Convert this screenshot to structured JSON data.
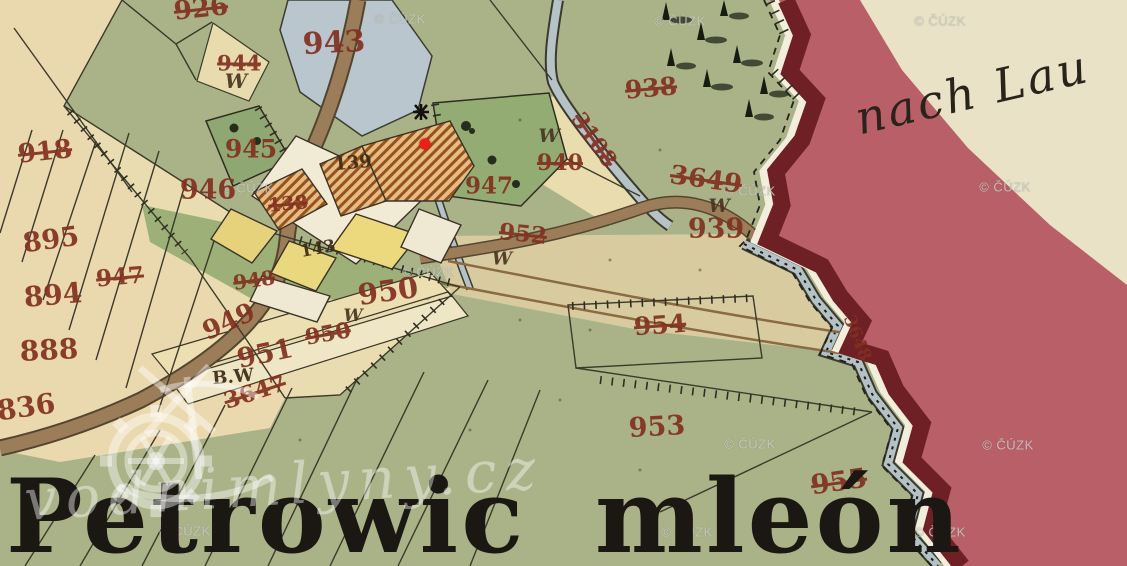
{
  "map": {
    "region_label": "Petrowic mleón",
    "direction_label": "nach Lau",
    "parcel_labels": [
      {
        "text": "926",
        "x": 201,
        "y": 9,
        "size": 26,
        "rot": -6,
        "struck": true,
        "cls": "red"
      },
      {
        "text": "943",
        "x": 334,
        "y": 43,
        "size": 30,
        "rot": -3,
        "struck": false,
        "cls": "red"
      },
      {
        "text": "944",
        "x": 239,
        "y": 63,
        "size": 21,
        "rot": 0,
        "struck": true,
        "cls": "red"
      },
      {
        "text": "W",
        "x": 236,
        "y": 81,
        "size": 20,
        "rot": 0,
        "struck": false,
        "cls": "w"
      },
      {
        "text": "918",
        "x": 45,
        "y": 152,
        "size": 26,
        "rot": -6,
        "struck": true,
        "cls": "red"
      },
      {
        "text": "945",
        "x": 251,
        "y": 149,
        "size": 25,
        "rot": 0,
        "struck": false,
        "cls": "red"
      },
      {
        "text": "946",
        "x": 208,
        "y": 190,
        "size": 27,
        "rot": 0,
        "struck": false,
        "cls": "red"
      },
      {
        "text": "938",
        "x": 651,
        "y": 88,
        "size": 25,
        "rot": -5,
        "struck": true,
        "cls": "red"
      },
      {
        "text": "W",
        "x": 549,
        "y": 136,
        "size": 19,
        "rot": 0,
        "struck": false,
        "cls": "w"
      },
      {
        "text": "940",
        "x": 560,
        "y": 163,
        "size": 22,
        "rot": 0,
        "struck": true,
        "cls": "red"
      },
      {
        "text": "947",
        "x": 489,
        "y": 186,
        "size": 23,
        "rot": 0,
        "struck": false,
        "cls": "red"
      },
      {
        "text": "947",
        "x": 120,
        "y": 277,
        "size": 23,
        "rot": -5,
        "struck": true,
        "cls": "red"
      },
      {
        "text": "895",
        "x": 51,
        "y": 240,
        "size": 27,
        "rot": -8,
        "struck": false,
        "cls": "red"
      },
      {
        "text": "894",
        "x": 53,
        "y": 295,
        "size": 28,
        "rot": -5,
        "struck": false,
        "cls": "red"
      },
      {
        "text": "888",
        "x": 49,
        "y": 350,
        "size": 28,
        "rot": -3,
        "struck": false,
        "cls": "red"
      },
      {
        "text": "836",
        "x": 26,
        "y": 407,
        "size": 28,
        "rot": -8,
        "struck": false,
        "cls": "red"
      },
      {
        "text": "3649",
        "x": 706,
        "y": 180,
        "size": 26,
        "rot": 8,
        "struck": true,
        "cls": "red"
      },
      {
        "text": "W",
        "x": 719,
        "y": 206,
        "size": 19,
        "rot": 0,
        "struck": false,
        "cls": "w"
      },
      {
        "text": "939",
        "x": 716,
        "y": 229,
        "size": 27,
        "rot": 0,
        "struck": false,
        "cls": "red"
      },
      {
        "text": "952",
        "x": 523,
        "y": 234,
        "size": 23,
        "rot": 6,
        "struck": true,
        "cls": "red"
      },
      {
        "text": "W",
        "x": 502,
        "y": 259,
        "size": 18,
        "rot": 0,
        "struck": false,
        "cls": "w"
      },
      {
        "text": "W",
        "x": 353,
        "y": 316,
        "size": 17,
        "rot": 0,
        "struck": false,
        "cls": "w"
      },
      {
        "text": "950",
        "x": 388,
        "y": 291,
        "size": 29,
        "rot": -8,
        "struck": false,
        "cls": "red"
      },
      {
        "text": "950",
        "x": 328,
        "y": 334,
        "size": 22,
        "rot": -10,
        "struck": true,
        "cls": "red"
      },
      {
        "text": "949",
        "x": 229,
        "y": 322,
        "size": 26,
        "rot": -24,
        "struck": false,
        "cls": "red"
      },
      {
        "text": "951",
        "x": 265,
        "y": 354,
        "size": 27,
        "rot": -12,
        "struck": false,
        "cls": "red"
      },
      {
        "text": "948",
        "x": 254,
        "y": 280,
        "size": 20,
        "rot": -8,
        "struck": true,
        "cls": "red"
      },
      {
        "text": "B.W",
        "x": 233,
        "y": 377,
        "size": 18,
        "rot": -5,
        "struck": false,
        "cls": "dark"
      },
      {
        "text": "3647",
        "x": 255,
        "y": 392,
        "size": 23,
        "rot": -18,
        "struck": true,
        "cls": "red"
      },
      {
        "text": "954",
        "x": 660,
        "y": 325,
        "size": 25,
        "rot": -4,
        "struck": true,
        "cls": "red"
      },
      {
        "text": "953",
        "x": 657,
        "y": 427,
        "size": 27,
        "rot": -3,
        "struck": false,
        "cls": "red"
      },
      {
        "text": "955",
        "x": 839,
        "y": 482,
        "size": 27,
        "rot": -8,
        "struck": true,
        "cls": "red"
      },
      {
        "text": "3648",
        "x": 857,
        "y": 338,
        "size": 17,
        "rot": 68,
        "struck": false,
        "cls": "red"
      },
      {
        "text": "3108",
        "x": 594,
        "y": 140,
        "size": 22,
        "rot": 55,
        "struck": true,
        "cls": "red"
      },
      {
        "text": "138",
        "x": 288,
        "y": 204,
        "size": 19,
        "rot": -5,
        "struck": true,
        "cls": "red"
      },
      {
        "text": "139",
        "x": 353,
        "y": 163,
        "size": 18,
        "rot": -5,
        "struck": false,
        "cls": "dark"
      },
      {
        "text": "143",
        "x": 318,
        "y": 249,
        "size": 17,
        "rot": -10,
        "struck": false,
        "cls": "dark"
      }
    ],
    "colors": {
      "map_green": "#aab388",
      "field_cream": "#ead9ae",
      "pond_blue": "#b9c6cd",
      "road_brown": "#9c7d59",
      "border_maroon": "#6e2024",
      "border_rose": "#b95f68",
      "paper_cream": "#e9e2c7",
      "label_red": "#823020"
    }
  },
  "marker": {
    "x": 425,
    "y": 144,
    "color": "#ee1f18"
  },
  "watermarks": {
    "cuzk_text": "© ČÚZK",
    "site_text": "vodnimlyny.cz",
    "positions": [
      {
        "x": 400,
        "y": 19
      },
      {
        "x": 680,
        "y": 21
      },
      {
        "x": 940,
        "y": 21
      },
      {
        "x": 248,
        "y": 188
      },
      {
        "x": 750,
        "y": 191
      },
      {
        "x": 1005,
        "y": 187
      },
      {
        "x": 428,
        "y": 272
      },
      {
        "x": 750,
        "y": 444
      },
      {
        "x": 1008,
        "y": 445
      },
      {
        "x": 185,
        "y": 531
      },
      {
        "x": 687,
        "y": 532
      },
      {
        "x": 940,
        "y": 532
      }
    ]
  }
}
